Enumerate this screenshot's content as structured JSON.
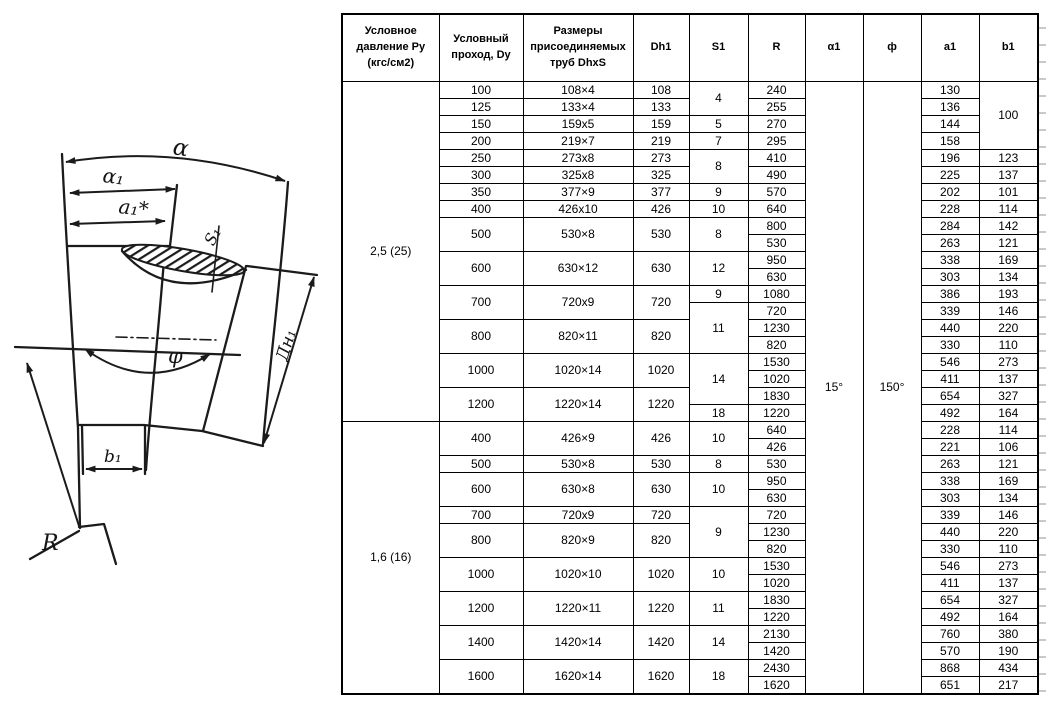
{
  "page": {
    "background": "#ffffff",
    "ink": "#1b1b1b"
  },
  "drawing": {
    "labels": {
      "alpha": "α",
      "alpha1": "α₁",
      "a1_star": "a₁*",
      "s1": "S₁",
      "phi": "φ",
      "dn1": "Дн₁",
      "b1": "b₁",
      "radius": "R"
    }
  },
  "table": {
    "headers": [
      "Условное давление Ру (кгс/см2)",
      "Условный проход, Dy",
      "Размеры присоединяемых труб DhxS",
      "Dh1",
      "S1",
      "R",
      "α1",
      "ф",
      "a1",
      "b1"
    ],
    "column_widths": [
      97,
      84,
      110,
      56,
      59,
      57,
      58,
      58,
      58,
      59
    ],
    "body": [
      [
        [
          "2,5 (25)",
          20
        ],
        [
          "100",
          1
        ],
        [
          "108×4",
          1
        ],
        [
          "108",
          1
        ],
        [
          "4",
          2
        ],
        [
          "240",
          1
        ],
        [
          "15°",
          36
        ],
        [
          "150°",
          36
        ],
        [
          "130",
          1
        ],
        [
          "100",
          4
        ]
      ],
      [
        [
          "125",
          1
        ],
        [
          "133×4",
          1
        ],
        [
          "133",
          1
        ],
        [
          "255",
          1
        ],
        [
          "136",
          1
        ]
      ],
      [
        [
          "150",
          1
        ],
        [
          "159x5",
          1
        ],
        [
          "159",
          1
        ],
        [
          "5",
          1
        ],
        [
          "270",
          1
        ],
        [
          "144",
          1
        ]
      ],
      [
        [
          "200",
          1
        ],
        [
          "219×7",
          1
        ],
        [
          "219",
          1
        ],
        [
          "7",
          1
        ],
        [
          "295",
          1
        ],
        [
          "158",
          1
        ]
      ],
      [
        [
          "250",
          1
        ],
        [
          "273x8",
          1
        ],
        [
          "273",
          1
        ],
        [
          "8",
          2
        ],
        [
          "410",
          1
        ],
        [
          "196",
          1
        ],
        [
          "123",
          1
        ]
      ],
      [
        [
          "300",
          1
        ],
        [
          "325x8",
          1
        ],
        [
          "325",
          1
        ],
        [
          "490",
          1
        ],
        [
          "225",
          1
        ],
        [
          "137",
          1
        ]
      ],
      [
        [
          "350",
          1
        ],
        [
          "377×9",
          1
        ],
        [
          "377",
          1
        ],
        [
          "9",
          1
        ],
        [
          "570",
          1
        ],
        [
          "202",
          1
        ],
        [
          "101",
          1
        ]
      ],
      [
        [
          "400",
          1
        ],
        [
          "426x10",
          1
        ],
        [
          "426",
          1
        ],
        [
          "10",
          1
        ],
        [
          "640",
          1
        ],
        [
          "228",
          1
        ],
        [
          "114",
          1
        ]
      ],
      [
        [
          "500",
          2
        ],
        [
          "530×8",
          2
        ],
        [
          "530",
          2
        ],
        [
          "8",
          2
        ],
        [
          "800",
          1
        ],
        [
          "284",
          1
        ],
        [
          "142",
          1
        ]
      ],
      [
        [
          "530",
          1
        ],
        [
          "263",
          1
        ],
        [
          "121",
          1
        ]
      ],
      [
        [
          "600",
          2
        ],
        [
          "630×12",
          2
        ],
        [
          "630",
          2
        ],
        [
          "12",
          2
        ],
        [
          "950",
          1
        ],
        [
          "338",
          1
        ],
        [
          "169",
          1
        ]
      ],
      [
        [
          "630",
          1
        ],
        [
          "303",
          1
        ],
        [
          "134",
          1
        ]
      ],
      [
        [
          "700",
          2
        ],
        [
          "720x9",
          2
        ],
        [
          "720",
          2
        ],
        [
          "9",
          1
        ],
        [
          "1080",
          1
        ],
        [
          "386",
          1
        ],
        [
          "193",
          1
        ]
      ],
      [
        [
          "11",
          3
        ],
        [
          "720",
          1
        ],
        [
          "339",
          1
        ],
        [
          "146",
          1
        ]
      ],
      [
        [
          "800",
          2
        ],
        [
          "820×11",
          2
        ],
        [
          "820",
          2
        ],
        [
          "1230",
          1
        ],
        [
          "440",
          1
        ],
        [
          "220",
          1
        ]
      ],
      [
        [
          "820",
          1
        ],
        [
          "330",
          1
        ],
        [
          "110",
          1
        ]
      ],
      [
        [
          "1000",
          2
        ],
        [
          "1020×14",
          2
        ],
        [
          "1020",
          2
        ],
        [
          "14",
          3
        ],
        [
          "1530",
          1
        ],
        [
          "546",
          1
        ],
        [
          "273",
          1
        ]
      ],
      [
        [
          "1020",
          1
        ],
        [
          "411",
          1
        ],
        [
          "137",
          1
        ]
      ],
      [
        [
          "1200",
          2
        ],
        [
          "1220×14",
          2
        ],
        [
          "1220",
          2
        ],
        [
          "1830",
          1
        ],
        [
          "654",
          1
        ],
        [
          "327",
          1
        ]
      ],
      [
        [
          "18",
          1
        ],
        [
          "1220",
          1
        ],
        [
          "492",
          1
        ],
        [
          "164",
          1
        ]
      ],
      [
        [
          "1,6 (16)",
          16
        ],
        [
          "400",
          2
        ],
        [
          "426×9",
          2
        ],
        [
          "426",
          2
        ],
        [
          "10",
          2
        ],
        [
          "640",
          1
        ],
        [
          "228",
          1
        ],
        [
          "114",
          1
        ]
      ],
      [
        [
          "426",
          1
        ],
        [
          "221",
          1
        ],
        [
          "106",
          1
        ]
      ],
      [
        [
          "500",
          1
        ],
        [
          "530×8",
          1
        ],
        [
          "530",
          1
        ],
        [
          "8",
          1
        ],
        [
          "530",
          1
        ],
        [
          "263",
          1
        ],
        [
          "121",
          1
        ]
      ],
      [
        [
          "600",
          2
        ],
        [
          "630×8",
          2
        ],
        [
          "630",
          2
        ],
        [
          "10",
          2
        ],
        [
          "950",
          1
        ],
        [
          "338",
          1
        ],
        [
          "169",
          1
        ]
      ],
      [
        [
          "630",
          1
        ],
        [
          "303",
          1
        ],
        [
          "134",
          1
        ]
      ],
      [
        [
          "700",
          1
        ],
        [
          "720x9",
          1
        ],
        [
          "720",
          1
        ],
        [
          "9",
          3
        ],
        [
          "720",
          1
        ],
        [
          "339",
          1
        ],
        [
          "146",
          1
        ]
      ],
      [
        [
          "800",
          2
        ],
        [
          "820×9",
          2
        ],
        [
          "820",
          2
        ],
        [
          "1230",
          1
        ],
        [
          "440",
          1
        ],
        [
          "220",
          1
        ]
      ],
      [
        [
          "820",
          1
        ],
        [
          "330",
          1
        ],
        [
          "110",
          1
        ]
      ],
      [
        [
          "1000",
          2
        ],
        [
          "1020×10",
          2
        ],
        [
          "1020",
          2
        ],
        [
          "10",
          2
        ],
        [
          "1530",
          1
        ],
        [
          "546",
          1
        ],
        [
          "273",
          1
        ]
      ],
      [
        [
          "1020",
          1
        ],
        [
          "411",
          1
        ],
        [
          "137",
          1
        ]
      ],
      [
        [
          "1200",
          2
        ],
        [
          "1220×11",
          2
        ],
        [
          "1220",
          2
        ],
        [
          "11",
          2
        ],
        [
          "1830",
          1
        ],
        [
          "654",
          1
        ],
        [
          "327",
          1
        ]
      ],
      [
        [
          "1220",
          1
        ],
        [
          "492",
          1
        ],
        [
          "164",
          1
        ]
      ],
      [
        [
          "1400",
          2
        ],
        [
          "1420×14",
          2
        ],
        [
          "1420",
          2
        ],
        [
          "14",
          2
        ],
        [
          "2130",
          1
        ],
        [
          "760",
          1
        ],
        [
          "380",
          1
        ]
      ],
      [
        [
          "1420",
          1
        ],
        [
          "570",
          1
        ],
        [
          "190",
          1
        ]
      ],
      [
        [
          "1600",
          2
        ],
        [
          "1620×14",
          2
        ],
        [
          "1620",
          2
        ],
        [
          "18",
          2
        ],
        [
          "2430",
          1
        ],
        [
          "868",
          1
        ],
        [
          "434",
          1
        ]
      ],
      [
        [
          "1620",
          1
        ],
        [
          "651",
          1
        ],
        [
          "217",
          1
        ]
      ]
    ]
  }
}
